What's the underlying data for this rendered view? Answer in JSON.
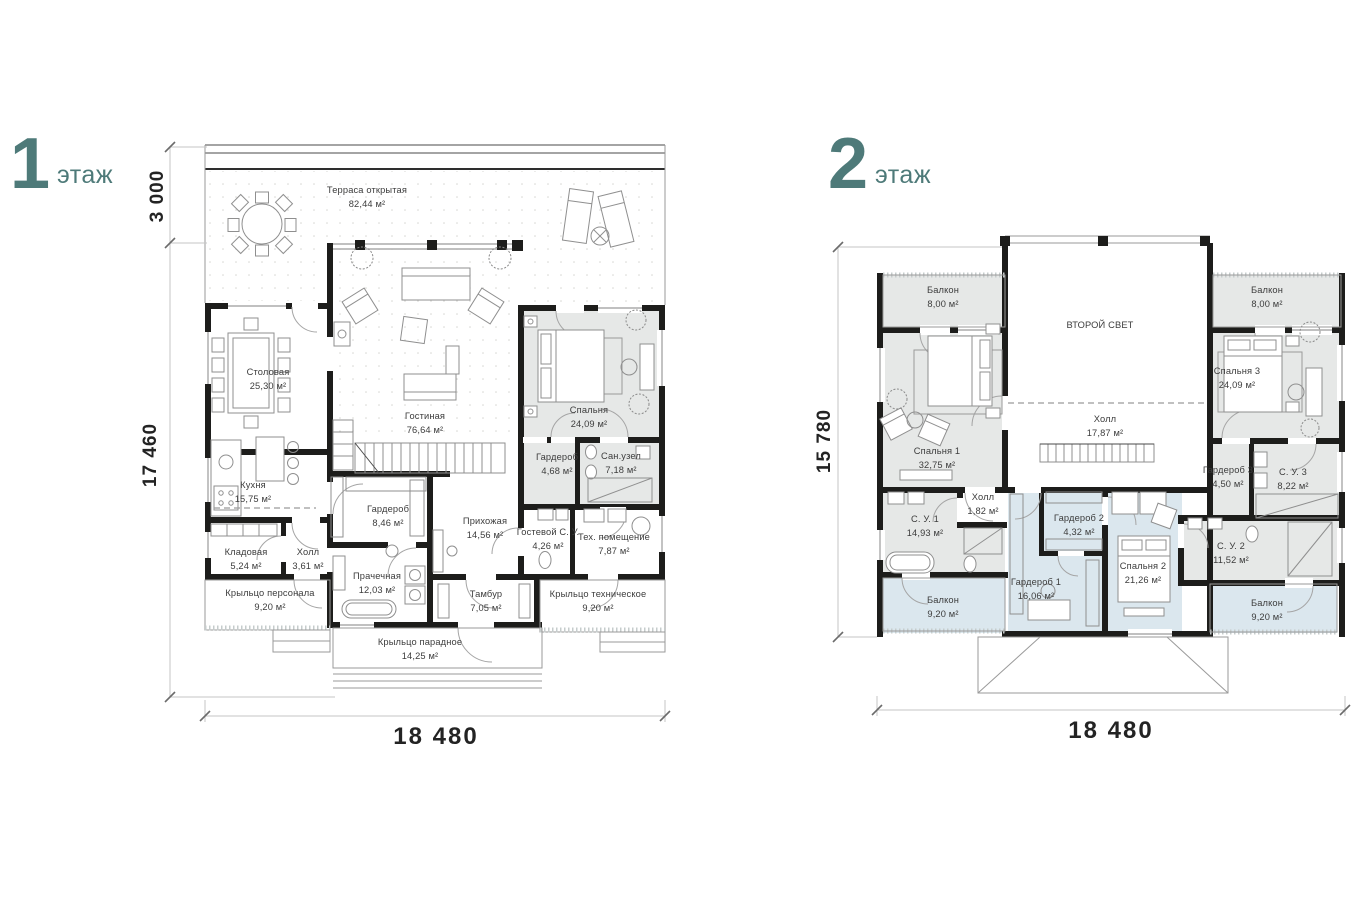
{
  "colors": {
    "accent_teal": "#4e7a79",
    "wall_black": "#1d1d1b",
    "room_gray": "#e6e8e7",
    "room_blue": "#dbe7ee"
  },
  "floor1": {
    "number": "1",
    "floor_word": "этаж",
    "dims": {
      "top": "3 000",
      "left": "17 460",
      "bottom": "18 480"
    },
    "rooms": [
      {
        "name": "Терраса открытая",
        "area": "82,44 м²"
      },
      {
        "name": "Столовая",
        "area": "25,30 м²"
      },
      {
        "name": "Гостиная",
        "area": "76,64 м²"
      },
      {
        "name": "Спальня",
        "area": "24,09 м²"
      },
      {
        "name": "Кухня",
        "area": "15,75 м²"
      },
      {
        "name": "Гардероб",
        "area": "8,46 м²"
      },
      {
        "name": "Гардероб",
        "area": "4,68 м²"
      },
      {
        "name": "Сан.узел",
        "area": "7,18 м²"
      },
      {
        "name": "Кладовая",
        "area": "5,24 м²"
      },
      {
        "name": "Холл",
        "area": "3,61 м²"
      },
      {
        "name": "Прихожая",
        "area": "14,56 м²"
      },
      {
        "name": "Гостевой С. У.",
        "area": "4,26 м²"
      },
      {
        "name": "Тех. помещение",
        "area": "7,87 м²"
      },
      {
        "name": "Крыльцо персонала",
        "area": "9,20 м²"
      },
      {
        "name": "Прачечная",
        "area": "12,03 м²"
      },
      {
        "name": "Тамбур",
        "area": "7,05 м²"
      },
      {
        "name": "Крыльцо техническое",
        "area": "9,20 м²"
      },
      {
        "name": "Крыльцо парадное",
        "area": "14,25 м²"
      }
    ]
  },
  "floor2": {
    "number": "2",
    "floor_word": "этаж",
    "dims": {
      "left": "15 780",
      "bottom": "18 480"
    },
    "second_light_label": "ВТОРОЙ СВЕТ",
    "rooms": [
      {
        "name": "Балкон",
        "area": "8,00 м²"
      },
      {
        "name": "Балкон",
        "area": "8,00 м²"
      },
      {
        "name": "Спальня 1",
        "area": "32,75 м²"
      },
      {
        "name": "Холл",
        "area": "17,87 м²"
      },
      {
        "name": "Спальня 3",
        "area": "24,09 м²"
      },
      {
        "name": "Холл",
        "area": "1,82 м²"
      },
      {
        "name": "С. У. 1",
        "area": "14,93 м²"
      },
      {
        "name": "Гардероб 2",
        "area": "4,32 м²"
      },
      {
        "name": "Гардероб 3",
        "area": "4,50 м²"
      },
      {
        "name": "С. У. 3",
        "area": "8,22 м²"
      },
      {
        "name": "Гардероб 1",
        "area": "16,06 м²"
      },
      {
        "name": "Спальня 2",
        "area": "21,26 м²"
      },
      {
        "name": "С. У. 2",
        "area": "11,52 м²"
      },
      {
        "name": "Балкон",
        "area": "9,20 м²"
      },
      {
        "name": "Балкон",
        "area": "9,20 м²"
      }
    ]
  }
}
